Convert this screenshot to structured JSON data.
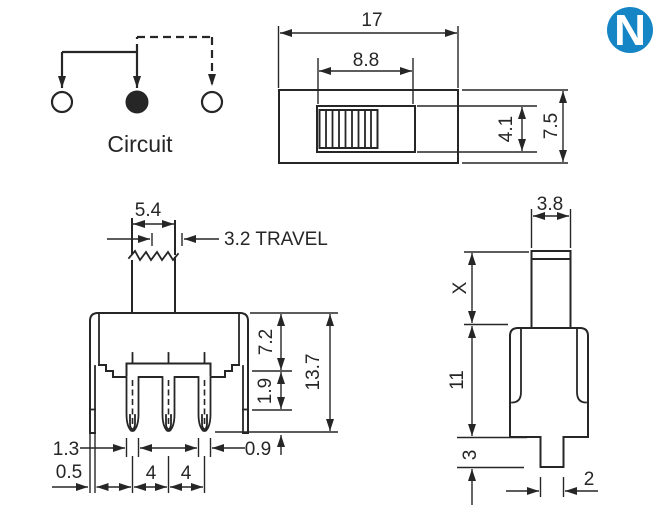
{
  "colors": {
    "line": "#262626",
    "logo_blue": "#1585c5"
  },
  "logo": {
    "letter": "N"
  },
  "circuit": {
    "label": "Circuit"
  },
  "top_view": {
    "length": "17",
    "slot_length": "8.8",
    "slot_width": "4.1",
    "width": "7.5"
  },
  "front_view": {
    "knob_width": "5.4",
    "travel": "3.2 TRAVEL",
    "body_height": "7.2",
    "boss_height": "1.9",
    "total_height": "13.7",
    "pin_width": "1.3",
    "bracket_width": "0.5",
    "pitch_left": "4",
    "pitch_right": "4",
    "pin_tip_width": "0.9"
  },
  "side_view": {
    "knob_thickness": "3.8",
    "knob_height": "X",
    "body_height": "11",
    "terminal_length": "3",
    "terminal_width": "2"
  }
}
